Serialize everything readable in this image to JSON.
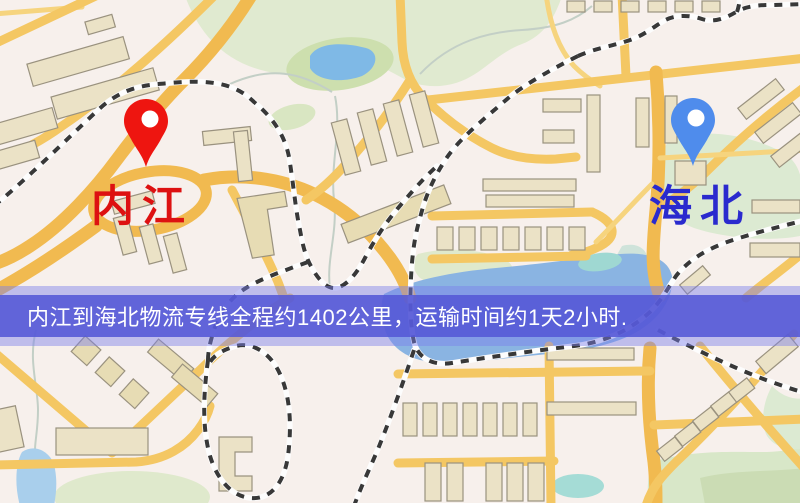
{
  "origin": {
    "label": "内江",
    "pin_color": "#ee1510",
    "label_color": "#dd1111"
  },
  "destination": {
    "label": "海北",
    "pin_color": "#4f8cec",
    "label_color": "#2a2ace"
  },
  "banner": {
    "text": "内江到海北物流专线全程约1402公里，运输时间约1天2小时.",
    "distance_km": "1402",
    "duration": "1天2小时",
    "bg_color": "#5458d6",
    "text_color": "#ffffff"
  },
  "map_colors": {
    "background": "#f7f0ec",
    "road_major": "#f1ba50",
    "road_minor": "#f4c763",
    "railway_dash": "#383838",
    "water": "#8ab4e2",
    "park": "#dfe9cc",
    "building": "#ebe2c6"
  }
}
